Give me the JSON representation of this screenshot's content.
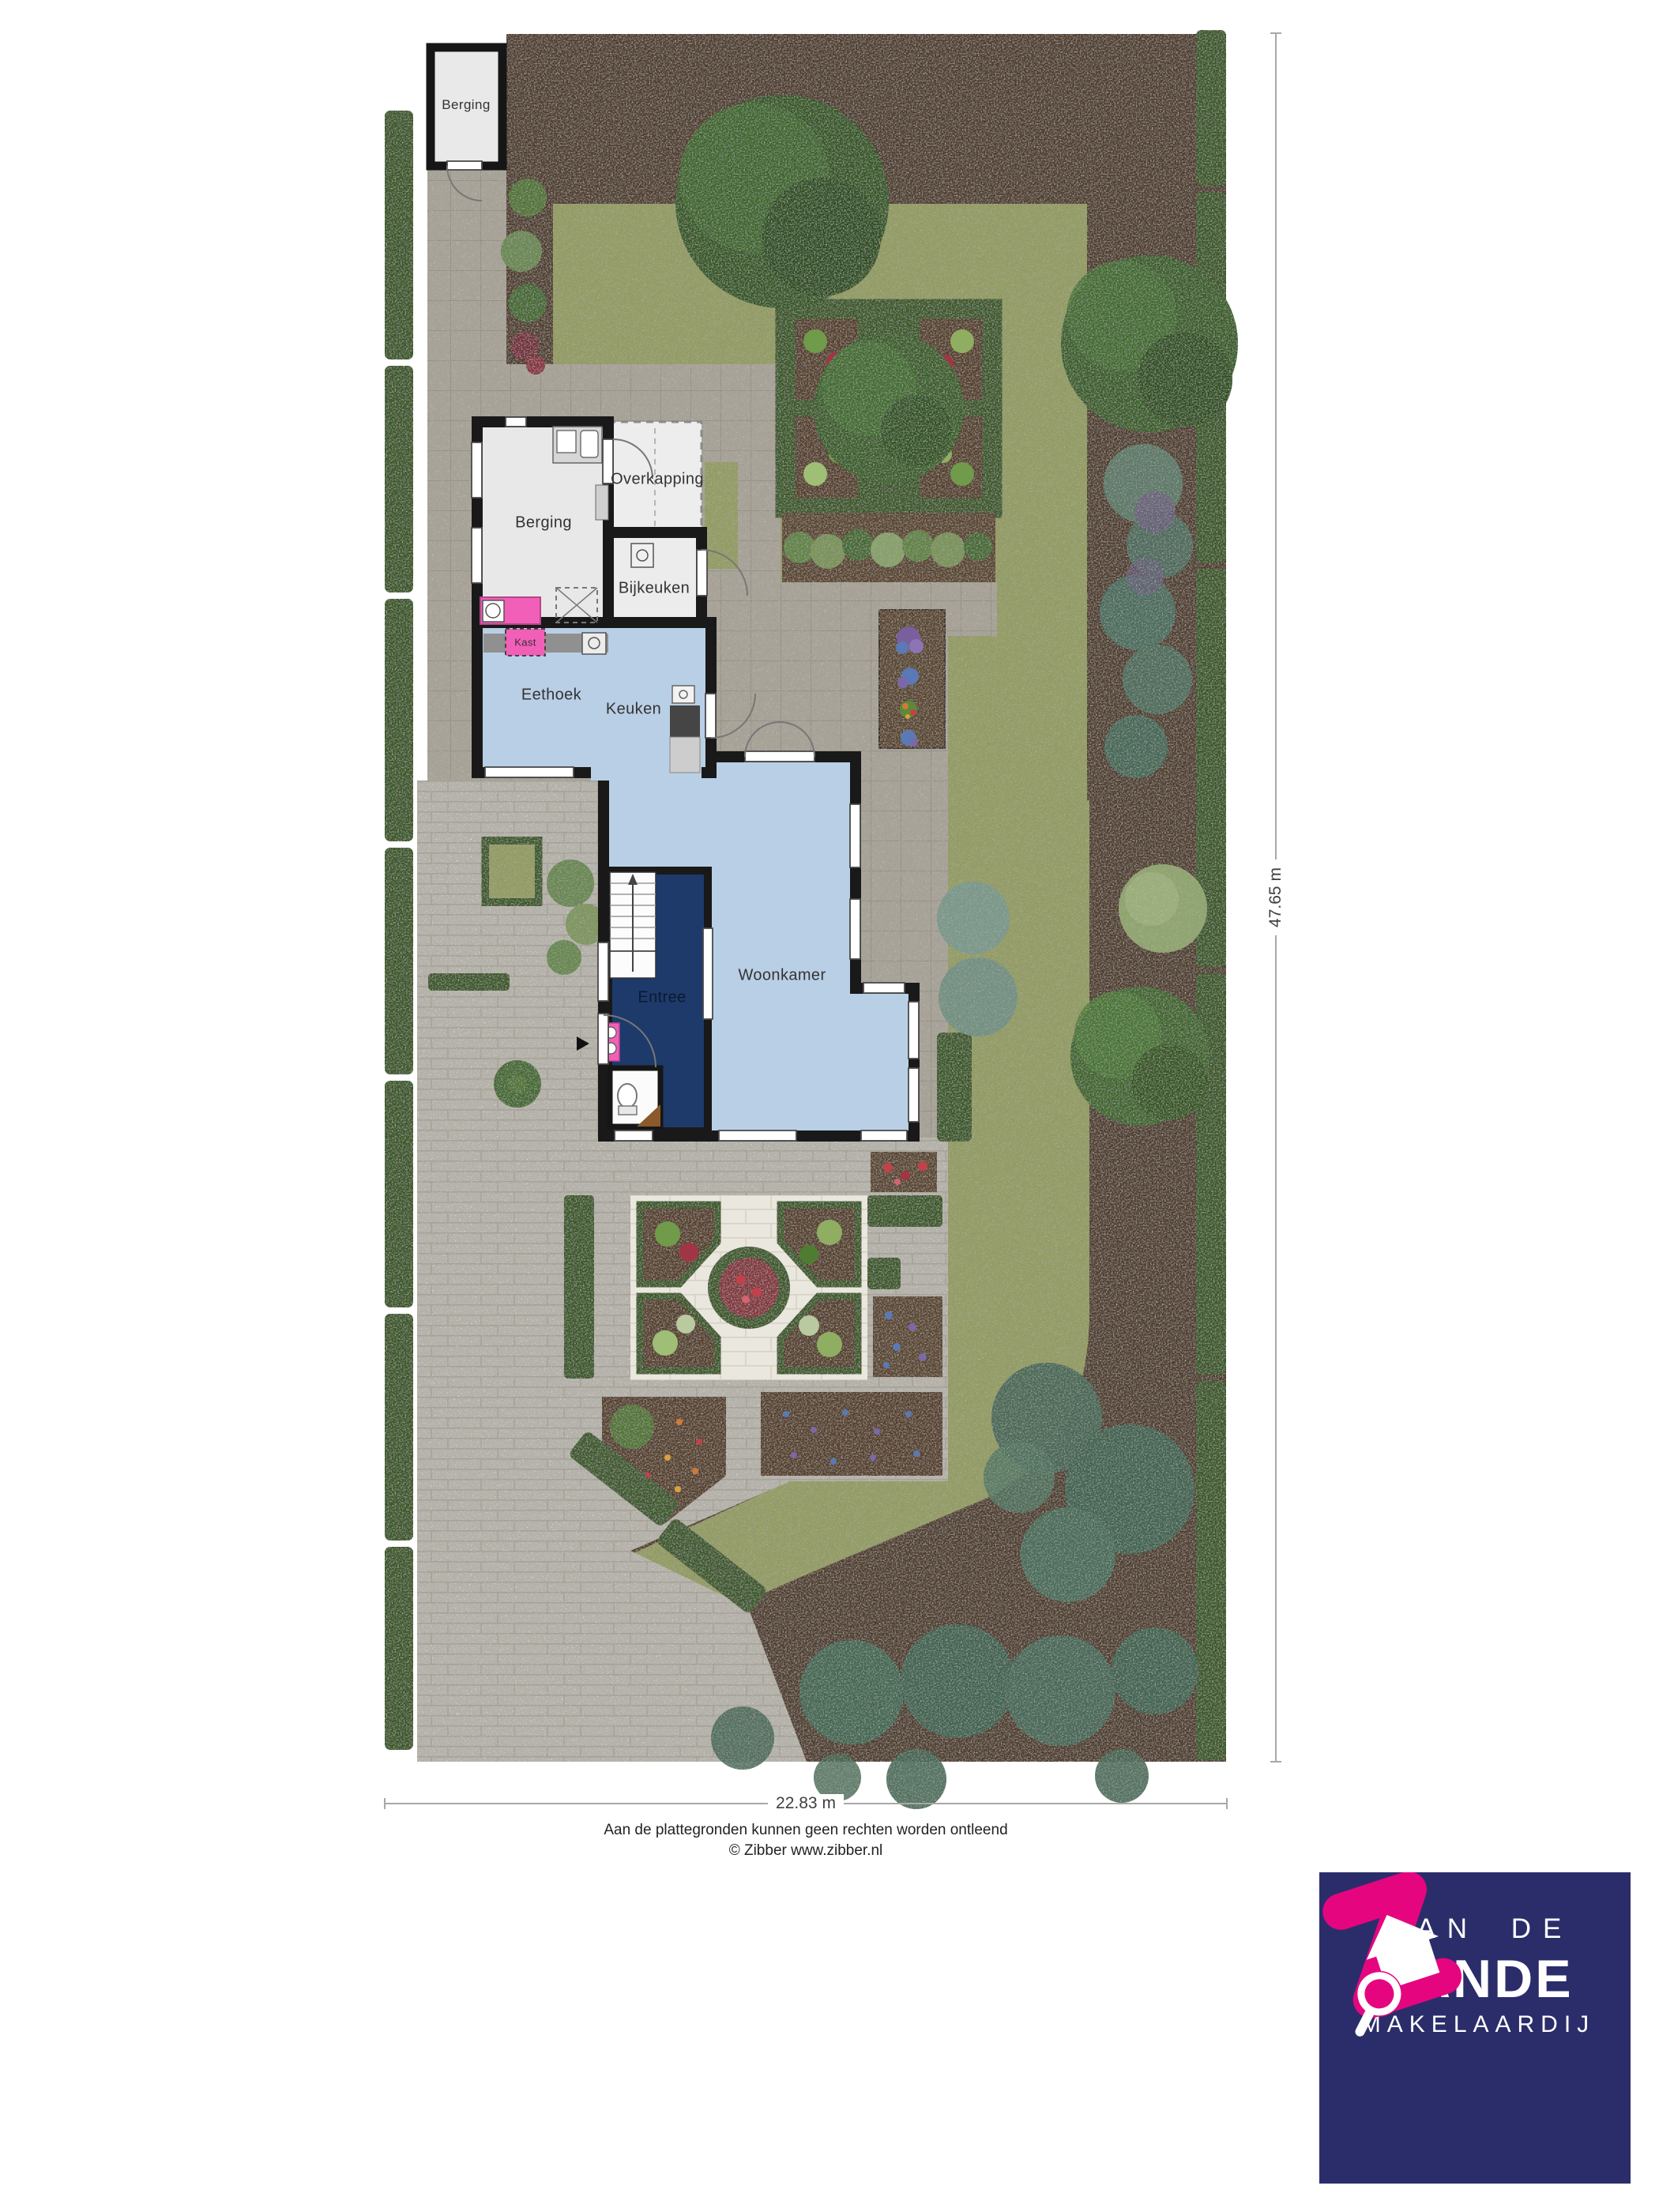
{
  "plan": {
    "title": "Tuinplattegrond begane grond",
    "rooms": {
      "shed_berging": "Berging",
      "berging": "Berging",
      "overkapping": "Overkapping",
      "bijkeuken": "Bijkeuken",
      "kast": "Kast",
      "eethoek": "Eethoek",
      "keuken": "Keuken",
      "woonkamer": "Woonkamer",
      "entree": "Entree"
    },
    "dimensions": {
      "plot_width": "22.83 m",
      "plot_depth": "47.65 m"
    },
    "footer": {
      "disclaimer": "Aan de plattegronden kunnen geen rechten worden ontleend",
      "copyright": "© Zibber www.zibber.nl"
    },
    "logo": {
      "line1": "VAN DE",
      "line2": "ZANDE",
      "line3": "MAKELAARDIJ",
      "icon": "house-magnifier-icon"
    },
    "colors": {
      "soil": "#5e4630",
      "lawn": "#aeba6e",
      "hedge": "#436827",
      "paving": "#c8c1b2",
      "driveway": "#dcd8ce",
      "stone": "#eae7de",
      "wall": "#191919",
      "room-gray": "#e8e8e8",
      "floor-blue": "#b9cfe6",
      "floor-navy": "#1d3a6b",
      "pink": "#f25fb8",
      "logo-navy": "#2b2d6a",
      "logo-pink": "#e5067f",
      "dim-line": "#a8a8a8",
      "text": "#333333"
    }
  }
}
